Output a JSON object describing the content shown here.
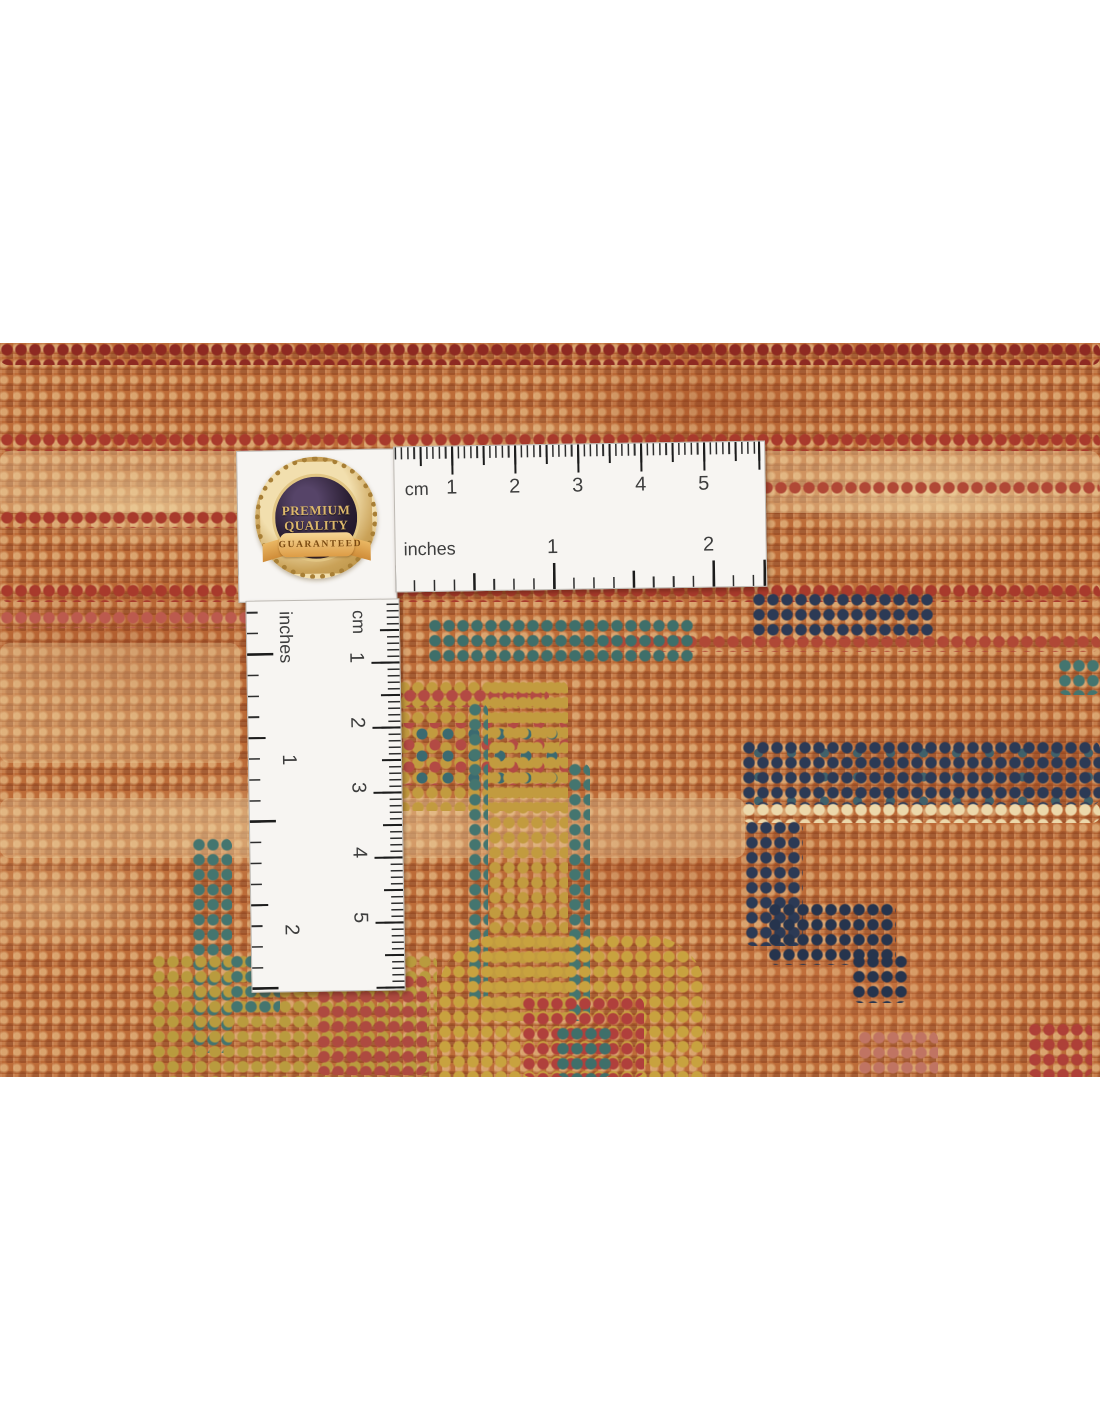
{
  "badge": {
    "line1": "PREMIUM",
    "line2": "QUALITY",
    "ribbon": "GUARANTEED"
  },
  "ruler_h": {
    "cm_label": "cm",
    "in_label": "inches",
    "cm": [
      "1",
      "2",
      "3",
      "4",
      "5"
    ],
    "in": [
      "1",
      "2"
    ]
  },
  "ruler_v": {
    "cm_label": "cm",
    "in_label": "inches",
    "cm": [
      "1",
      "2",
      "3",
      "4",
      "5"
    ],
    "in": [
      "1",
      "2"
    ]
  },
  "colors": {
    "rug_base": "#bd6c38",
    "stripe_red": "#a83a2c",
    "dark_red": "#8e2a22",
    "navy": "#2c3a55",
    "teal": "#44756f",
    "gold": "#c29b3f",
    "cream": "#ecd8ab",
    "badge_gold": "#caa258",
    "ruler_white": "#f7f5f2"
  }
}
